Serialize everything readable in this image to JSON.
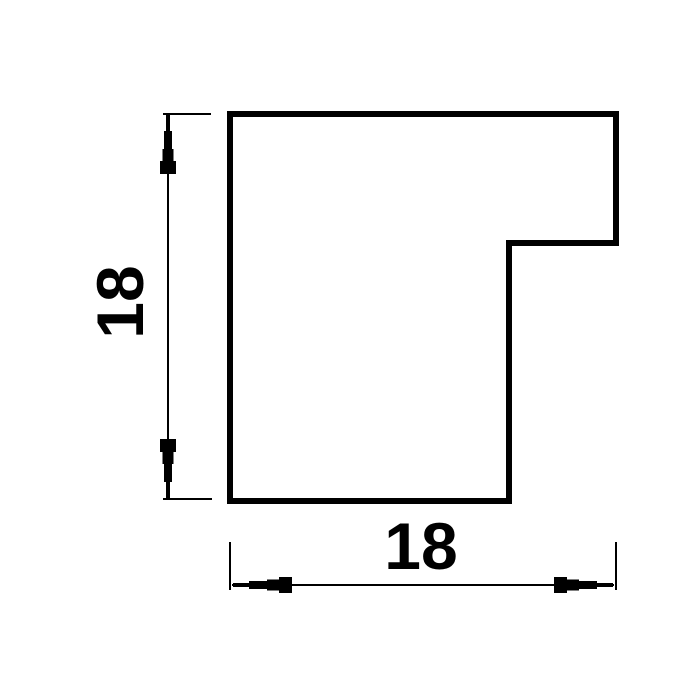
{
  "drawing": {
    "title": "profile-cross-section",
    "vertical_dimension": {
      "label": "18"
    },
    "horizontal_dimension": {
      "label": "18"
    },
    "colors": {
      "line": "#000000",
      "background": "#ffffff"
    }
  }
}
